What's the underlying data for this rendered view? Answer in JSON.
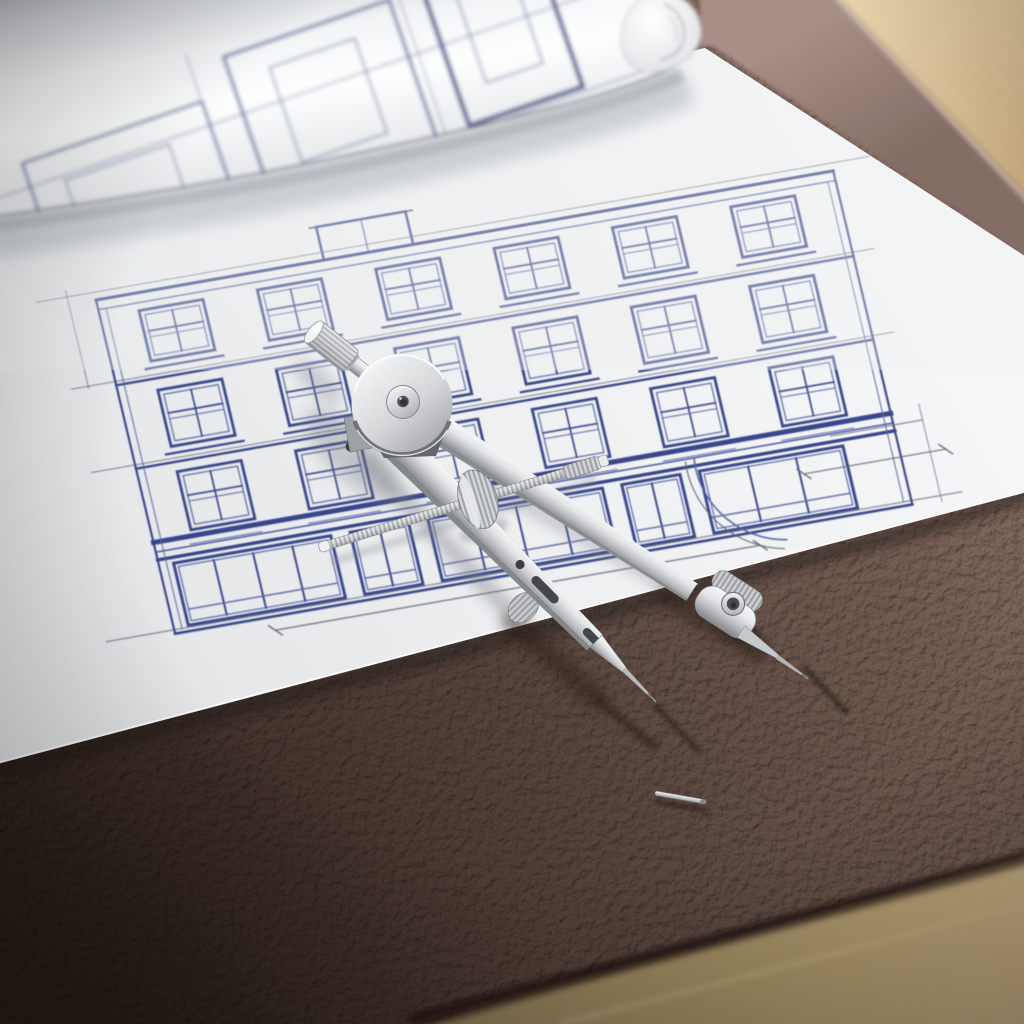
{
  "meta": {
    "caption": "Architectural blueprint of a classical building facade on a white sheet lying on a brown leather desk pad, with a polished steel drafting compass resting on the drawing, a rolled-up blueprint at the top left, a wooden desk surface visible at the corners, and a tiny spare needle pin lying on the leather.",
    "alt": "Blueprint of a building facade with a steel drafting compass and rolled plans on a leather desk pad"
  },
  "scene": {
    "objects": [
      {
        "name": "wood-desk-surface",
        "desc": "light oak desk visible at top-right and bottom-right corners"
      },
      {
        "name": "leather-desk-pad",
        "desc": "pebbled brown leather desk pad covering most of the desk"
      },
      {
        "name": "blueprint-sheet",
        "desc": "white sheet with blue ink elevation drawing of a multi-storey building"
      },
      {
        "name": "rolled-blueprint",
        "desc": "rolled sheet of plans lying across the top-left"
      },
      {
        "name": "drafting-compass",
        "desc": "stainless steel bow compass / divider with knurled handle, pivot disc, two needle legs and adjustment screw"
      },
      {
        "name": "metal-pin",
        "desc": "small spare steel pin on the leather pad"
      }
    ]
  },
  "palette": {
    "wood_light": "#d9c2a0",
    "wood_warm": "#b59a6f",
    "leather_light": "#7d665b",
    "leather_mid": "#5d4a42",
    "leather_dark": "#32261f",
    "paper": "#f3f4f5",
    "ink_blue": "#2e3d85",
    "metal_light": "#f2f3f4",
    "metal_dark": "#84878a"
  },
  "blueprint": {
    "facade": {
      "transform": "matrix(0.97 -0.17 0.23 0.97 96 300)",
      "width": 760,
      "ink": "#2e3d85",
      "ink_soft": "#4e5ca2",
      "construction": "#565c66",
      "h_lines": [
        {
          "y": -8,
          "x1": -60,
          "x2": 800,
          "w": 1,
          "c": "construction",
          "o": 0.7
        },
        {
          "y": 0,
          "x1": 0,
          "x2": 760,
          "w": 3,
          "c": "ink"
        },
        {
          "y": 10,
          "x1": 0,
          "x2": 760,
          "w": 1.4,
          "c": "ink_soft"
        },
        {
          "y": 84,
          "x1": -45,
          "x2": 782,
          "w": 1,
          "c": "construction",
          "o": 0.75
        },
        {
          "y": 88,
          "x1": 0,
          "x2": 760,
          "w": 2.4,
          "c": "ink"
        },
        {
          "y": 170,
          "x1": -45,
          "x2": 782,
          "w": 1,
          "c": "construction",
          "o": 0.75
        },
        {
          "y": 174,
          "x1": 0,
          "x2": 760,
          "w": 2.4,
          "c": "ink"
        },
        {
          "y": 250,
          "x1": 0,
          "x2": 760,
          "w": 5,
          "c": "ink"
        },
        {
          "y": 260,
          "x1": 0,
          "x2": 760,
          "w": 1.6,
          "c": "ink_soft"
        },
        {
          "y": 268,
          "x1": 0,
          "x2": 760,
          "w": 3.4,
          "c": "ink"
        },
        {
          "y": 340,
          "x1": -70,
          "x2": 812,
          "w": 1.1,
          "c": "construction",
          "o": 0.8
        },
        {
          "y": 344,
          "x1": 0,
          "x2": 760,
          "w": 2.6,
          "c": "ink"
        }
      ],
      "v_lines": [
        {
          "x": 0,
          "y1": 0,
          "y2": 344,
          "w": 2.2,
          "c": "ink"
        },
        {
          "x": 8,
          "y1": 10,
          "y2": 340,
          "w": 1,
          "c": "ink_soft"
        },
        {
          "x": 760,
          "y1": 0,
          "y2": 344,
          "w": 2.2,
          "c": "ink"
        },
        {
          "x": 752,
          "y1": 10,
          "y2": 340,
          "w": 1,
          "c": "ink_soft"
        },
        {
          "x": -28,
          "y1": -14,
          "y2": 86,
          "w": 1,
          "c": "construction",
          "o": 0.7
        },
        {
          "x": 790,
          "y1": 246,
          "y2": 346,
          "w": 1,
          "c": "construction",
          "o": 0.7
        }
      ],
      "chimney": {
        "x": 235,
        "y": -34,
        "w": 92,
        "h": 34,
        "divider_x": 281,
        "cap_overhang": 7
      },
      "window_rows": [
        {
          "y": 18,
          "h": 52,
          "under_lines": 0
        },
        {
          "y": 100,
          "h": 58,
          "under_lines": 0
        },
        {
          "y": 184,
          "h": 60,
          "under_lines": 1
        }
      ],
      "bays": [
        40,
        162,
        284,
        406,
        528,
        650
      ],
      "window_w": 66,
      "storefront": {
        "y": 274,
        "h": 64,
        "kick_dy": 48,
        "units": [
          {
            "x": 15,
            "w": 162,
            "panes": 4,
            "type": "shopfront"
          },
          {
            "x": 197,
            "w": 60,
            "panes": 2,
            "type": "door"
          },
          {
            "x": 277,
            "w": 180,
            "panes": 4,
            "type": "shopfront"
          },
          {
            "x": 477,
            "w": 60,
            "panes": 2,
            "type": "door"
          },
          {
            "x": 557,
            "w": 148,
            "panes": 3,
            "type": "shopfront"
          }
        ]
      },
      "arcs": [
        {
          "cx": 640,
          "cy": 272,
          "r": 86,
          "a1": 98,
          "a2": 188,
          "w": 1.6,
          "c": "ink_soft"
        },
        {
          "cx": 640,
          "cy": 272,
          "r": 95,
          "a1": 100,
          "a2": 186,
          "w": 1.1,
          "c": "construction"
        }
      ],
      "dim_lines": [
        {
          "x1": 100,
          "y1": 358,
          "x2": 600,
          "y2": 358,
          "w": 1.2,
          "c": "construction",
          "ticks": true
        },
        {
          "x1": 660,
          "y1": 295,
          "x2": 806,
          "y2": 295,
          "w": 1.1,
          "c": "construction",
          "ticks": true
        },
        {
          "x1": 695,
          "y1": 262,
          "x2": 790,
          "y2": 262,
          "w": 1,
          "c": "construction",
          "ticks": false
        }
      ]
    },
    "roll_doodles": {
      "rotate": "-19 300 110",
      "rects": [
        {
          "x": 20,
          "y": 70,
          "w": 190,
          "h": 120,
          "sw": 2.6
        },
        {
          "x": 55,
          "y": 100,
          "w": 110,
          "h": 60,
          "sw": 1.3
        },
        {
          "x": 245,
          "y": 35,
          "w": 175,
          "h": 160,
          "sw": 3
        },
        {
          "x": 285,
          "y": 60,
          "w": 90,
          "h": 100,
          "sw": 1.4
        },
        {
          "x": 455,
          "y": 20,
          "w": 120,
          "h": 160,
          "sw": 4.6,
          "c": "#2c3a78"
        },
        {
          "x": 485,
          "y": 50,
          "w": 60,
          "h": 95,
          "sw": 1.4
        }
      ],
      "lines": [
        {
          "x1": -20,
          "y1": 95,
          "x2": 640,
          "y2": 95,
          "sw": 1.2,
          "o": 0.7
        },
        {
          "x1": -20,
          "y1": 185,
          "x2": 640,
          "y2": 185,
          "sw": 1.2,
          "o": 0.7
        },
        {
          "x1": 210,
          "y1": 20,
          "x2": 210,
          "y2": 210,
          "sw": 1.1,
          "o": 0.6
        },
        {
          "x1": 430,
          "y1": 10,
          "x2": 430,
          "y2": 205,
          "sw": 1.1,
          "o": 0.6
        }
      ],
      "ink": "#3a4b92"
    }
  },
  "compass": {
    "parts": [
      "knurled-handle",
      "pivot-disc",
      "hub-screw",
      "left-leg",
      "right-leg",
      "slotted-blade",
      "adjustment-screw",
      "knurled-wheel",
      "thumb-nut",
      "left-needle",
      "right-needle"
    ]
  },
  "pin": {
    "x": 655,
    "y": 793,
    "angle": 10,
    "length": 52,
    "thickness": 4.5
  }
}
